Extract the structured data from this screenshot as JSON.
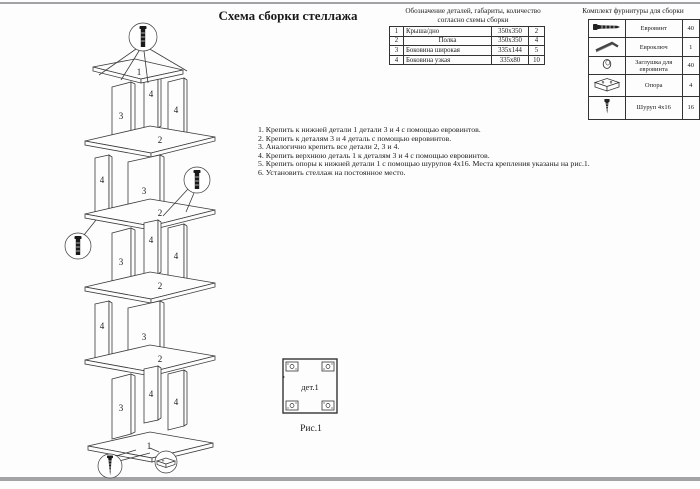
{
  "page": {
    "title": "Схема сборки стеллажа"
  },
  "colors": {
    "page_bg": "#fdfdfd",
    "text": "#1a1a1a",
    "line": "#3a3a3a",
    "scan_edge": "#a3a3a6"
  },
  "parts_table": {
    "caption_line1": "Обозначение деталей, габариты, количество",
    "caption_line2": "согласно схемы сборки",
    "rows": [
      {
        "num": "1",
        "name": "Крыша/дно",
        "size": "350х350",
        "qty": "2"
      },
      {
        "num": "2",
        "name": "Полка",
        "size": "350х350",
        "qty": "4"
      },
      {
        "num": "3",
        "name": "Боковина широкая",
        "size": "335х144",
        "qty": "5"
      },
      {
        "num": "4",
        "name": "Боковина узкая",
        "size": "335х80",
        "qty": "10"
      }
    ]
  },
  "hardware_table": {
    "title": "Комплект фурнитуры для сборки",
    "rows": [
      {
        "icon": "euro-screw-icon",
        "name": "Евровинт",
        "qty": "40"
      },
      {
        "icon": "hex-key-icon",
        "name": "Евроключ",
        "qty": "1"
      },
      {
        "icon": "cap-icon",
        "name": "Заглушка для евровинта",
        "qty": "40"
      },
      {
        "icon": "support-icon",
        "name": "Опора",
        "qty": "4"
      },
      {
        "icon": "screw-icon",
        "name": "Шуруп 4х16",
        "qty": "16"
      }
    ]
  },
  "instructions": [
    "1. Крепить к нижней детали 1 детали 3 и 4 с помощью евровинтов.",
    "2. Крепить к деталям 3 и 4 деталь с помощью евровинтов.",
    "3. Аналогично крепить все детали 2, 3 и 4.",
    "4. Крепить верхнюю деталь 1 к деталям 3 и 4 с помощью евровинтов.",
    "5. Крепить опоры к нижней детали 1 с помощью шурупов 4х16. Места крепления указаны на рис.1.",
    "6. Установить стеллаж на постоянное место."
  ],
  "diagram": {
    "labels": {
      "top": "1",
      "shelf": "2",
      "wide": "3",
      "narrow": "4",
      "base": "1"
    },
    "callout_icons": [
      "euro-screw-icon",
      "euro-screw-icon",
      "euro-screw-icon",
      "screw-icon",
      "support-icon"
    ]
  },
  "figure": {
    "part_label": "дет.1",
    "caption": "Рис.1"
  }
}
